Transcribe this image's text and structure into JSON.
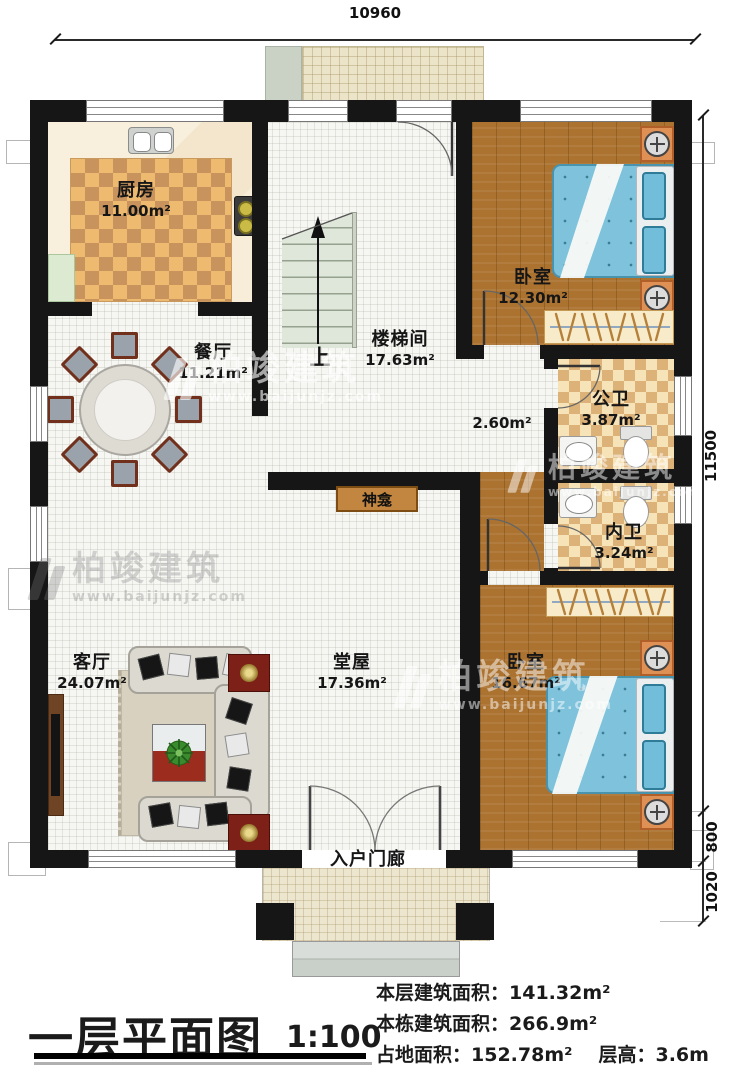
{
  "dims": {
    "top": "10960",
    "right_main": "11500",
    "right_mid": "800",
    "right_low": "1020"
  },
  "rooms": {
    "kitchen": {
      "name": "厨房",
      "area": "11.00m²"
    },
    "dining": {
      "name": "餐厅",
      "area": "11.21m²"
    },
    "stairwell": {
      "name": "楼梯间",
      "area": "17.63m²",
      "up": "上"
    },
    "bedroom_top": {
      "name": "卧室",
      "area": "12.30m²"
    },
    "bath_public": {
      "name": "公卫",
      "area": "3.87m²"
    },
    "lobby": {
      "area": "2.60m²"
    },
    "bath_private": {
      "name": "内卫",
      "area": "3.24m²"
    },
    "living": {
      "name": "客厅",
      "area": "24.07m²"
    },
    "hall": {
      "name": "堂屋",
      "area": "17.36m²"
    },
    "bedroom_bottom": {
      "name": "卧室",
      "area": "16.67m²"
    },
    "porch": {
      "name": "入户门廊"
    },
    "shrine": {
      "name": "神龛"
    }
  },
  "watermark": {
    "brand": "柏竣建筑",
    "url": "www.baijunjz.com"
  },
  "footer": {
    "title": "一层平面图",
    "scale": "1:100",
    "stat1_label": "本层建筑面积：",
    "stat1_value": "141.32m²",
    "stat2_label": "本栋建筑面积：",
    "stat2_value": "266.9m²",
    "stat3_label": "占地面积：",
    "stat3_value": "152.78m²",
    "stat4_label": "层高：",
    "stat4_value": "3.6m"
  }
}
